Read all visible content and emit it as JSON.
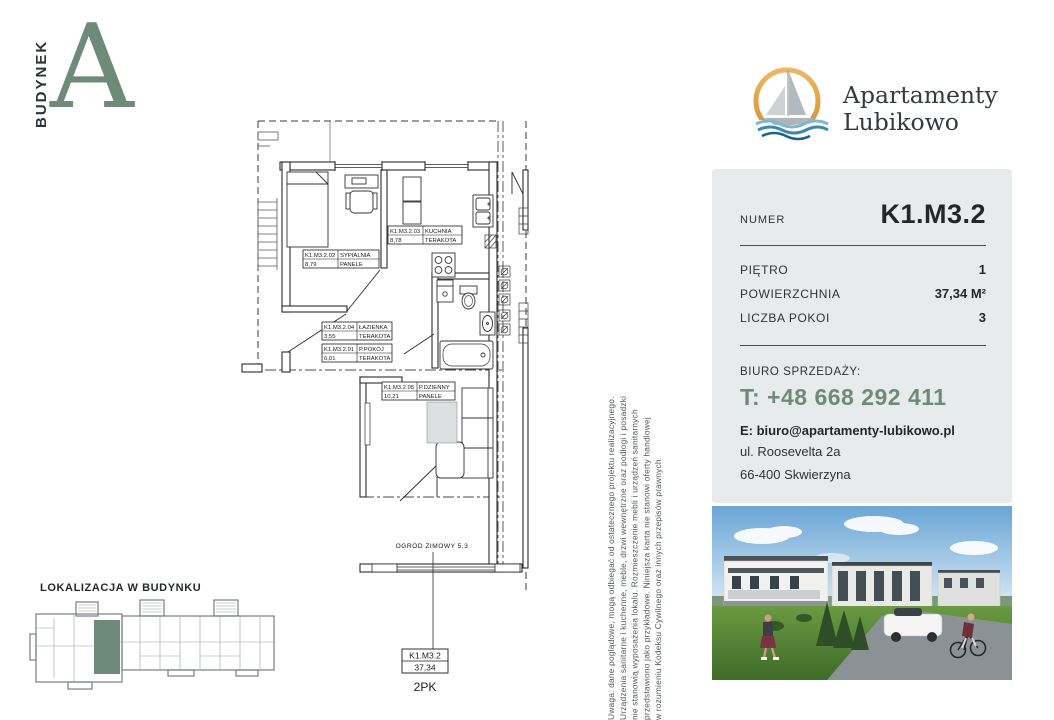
{
  "building": {
    "label": "BUDYNEK",
    "letter": "A"
  },
  "logo": {
    "line1": "Apartamenty",
    "line2": "Lubikowo"
  },
  "panel": {
    "number_label": "NUMER",
    "number_value": "K1.M3.2",
    "rows": [
      {
        "label": "PIĘTRO",
        "value": "1"
      },
      {
        "label": "POWIERZCHNIA",
        "value": "37,34 M²"
      },
      {
        "label": "LICZBA POKOI",
        "value": "3"
      }
    ],
    "office_label": "BIURO SPRZEDAŻY:",
    "phone": "T: +48 668 292 411",
    "email": "E: biuro@apartamenty-lubikowo.pl",
    "address1": "ul. Roosevelta 2a",
    "address2": "66-400 Skwierzyna"
  },
  "floorplan": {
    "rooms": [
      {
        "code": "K1.M3.2.02",
        "name": "SYPIALNIA",
        "area": "8,79",
        "floor": "PANELE"
      },
      {
        "code": "K1.M3.2.03",
        "name": "KUCHNIA",
        "area": "8,78",
        "floor": "TERAKOTA"
      },
      {
        "code": "K1.M3.2.04",
        "name": "ŁAZIENKA",
        "area": "3,55",
        "floor": "TERAKOTA"
      },
      {
        "code": "K1.M3.2.01",
        "name": "P.POKÓJ",
        "area": "6,01",
        "floor": "TERAKOTA"
      },
      {
        "code": "K1.M3.2.05",
        "name": "P.DZIENNY",
        "area": "10,21",
        "floor": "PANELE"
      }
    ],
    "winter_garden_label": "OGRÓD ZIMOWY 5,3",
    "summary": {
      "code": "K1.M3.2",
      "area": "37,34",
      "type": "2PK"
    }
  },
  "location": {
    "title": "LOKALIZACJA W BUDYNKU"
  },
  "disclaimer": {
    "lines": [
      "Uwaga: dane poglądowe, mogą odbiegać od ostatecznego projektu realizacyjnego.",
      "Urządzenia sanitarne i kuchenne, meble, drzwi wewnętrzne oraz podłogi i posadzki",
      "nie stanowią wyposażenia lokalu. Rozmieszczenie mebli i urządzeń sanitarnych",
      "przedstawiono jako przykładowe. Niniejsza karta nie stanowi oferty handlowej",
      "w rozumieniu Kodeksu Cywilnego oraz innych przepisów prawnych."
    ]
  },
  "colors": {
    "accent_green": "#6e8b7a",
    "panel_bg": "#e8ebeb",
    "logo_orange": "#dfa13f",
    "wave_blue": "#3c88ad",
    "text_dark": "#2e3133"
  }
}
